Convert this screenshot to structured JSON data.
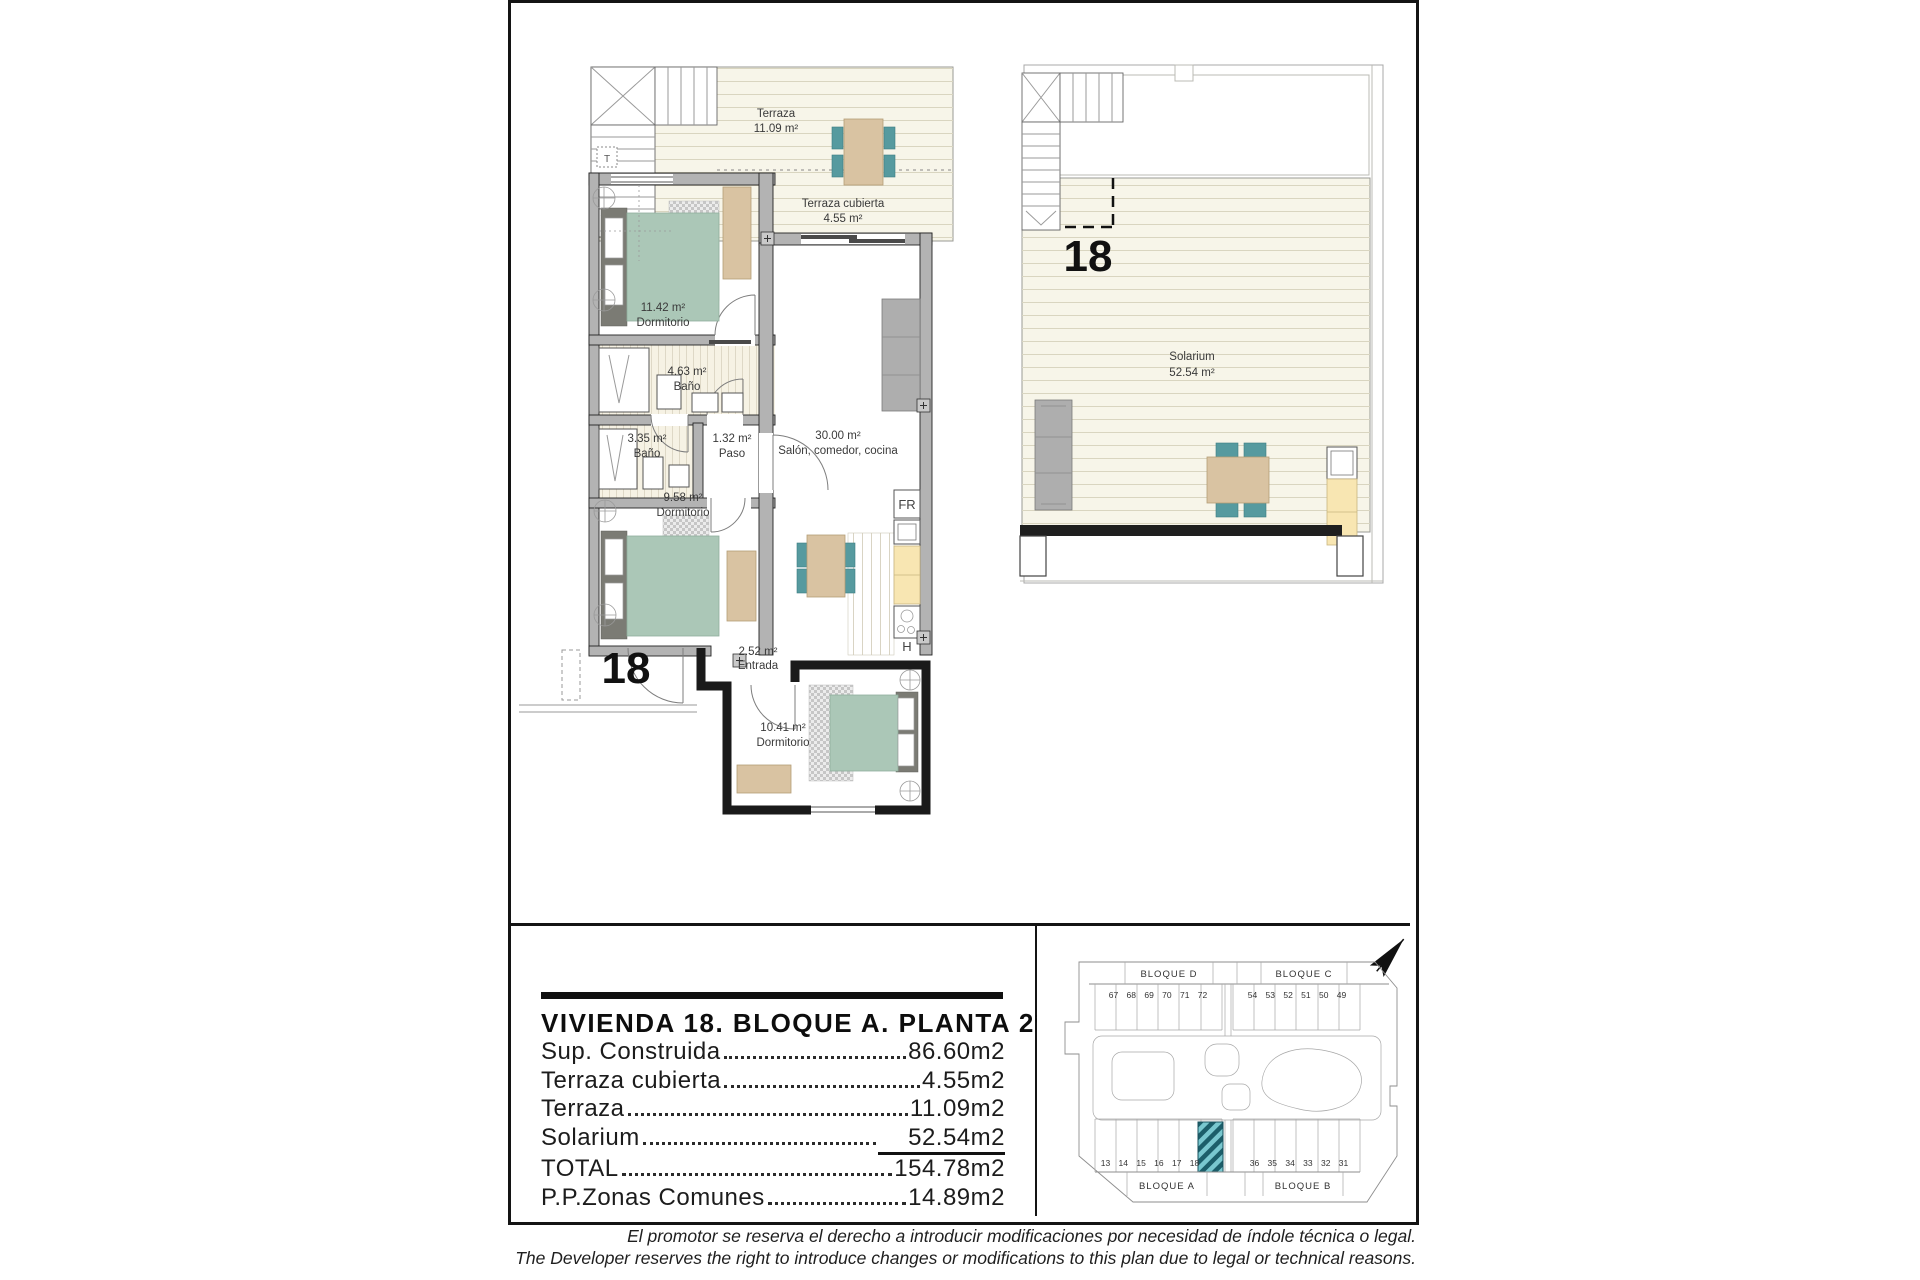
{
  "document": {
    "disclaimer_es": "El promotor se reserva el derecho a introducir modificaciones por necesidad de índole técnica o legal.",
    "disclaimer_en": "The Developer reserves the right to introduce changes or modifications to this plan due to legal or technical reasons."
  },
  "title_block": {
    "title": "VIVIENDA 18. BLOQUE A. PLANTA 2ª",
    "rows": {
      "r1": {
        "label": "Sup. Construida",
        "value": "86.60m2"
      },
      "r2": {
        "label": "Terraza cubierta",
        "value": "4.55m2"
      },
      "r3": {
        "label": "Terraza",
        "value": "11.09m2"
      },
      "r4": {
        "label": "Solarium",
        "value": "52.54m2"
      },
      "r5": {
        "label": "TOTAL",
        "value": "154.78m2"
      },
      "r6": {
        "label": "P.P.Zonas Comunes",
        "value": "14.89m2"
      }
    }
  },
  "floor_plan": {
    "unit_number": "18",
    "rooms": {
      "terraza": {
        "name": "Terraza",
        "area": "11.09 m²"
      },
      "terraza_cubierta": {
        "name": "Terraza cubierta",
        "area": "4.55 m²"
      },
      "dormitorio1": {
        "area": "11.42 m²",
        "name": "Dormitorio"
      },
      "bano1": {
        "area": "4.63 m²",
        "name": "Baño"
      },
      "bano2": {
        "area": "3.35 m²",
        "name": "Baño"
      },
      "paso": {
        "area": "1.32 m²",
        "name": "Paso"
      },
      "salon": {
        "area": "30.00 m²",
        "name": "Salón, comedor, cocina"
      },
      "dormitorio2": {
        "area": "9.58 m²",
        "name": "Dormitorio"
      },
      "entrada": {
        "area": "2.52 m²",
        "name": "Entrada"
      },
      "dormitorio3": {
        "area": "10.41 m²",
        "name": "Dormitorio"
      }
    },
    "labels": {
      "fridge": "FR",
      "hob": "H",
      "stair_t": "T"
    }
  },
  "solarium_plan": {
    "unit_number": "18",
    "room": {
      "name": "Solarium",
      "area": "52.54 m²"
    }
  },
  "site_plan": {
    "blocks": {
      "d": {
        "name": "BLOQUE D",
        "units": "67 68 69 70 71 72"
      },
      "c": {
        "name": "BLOQUE C",
        "units": "54 53 52 51 50 49"
      },
      "a": {
        "name": "BLOQUE A",
        "units": "13 14 15 16 17 18"
      },
      "b": {
        "name": "BLOQUE B",
        "units": "36 35 34 33 32 31"
      }
    },
    "highlighted_unit": "18"
  },
  "colors": {
    "accent_teal": "#569a9f",
    "highlight_hatch_dark": "#1c5e6a",
    "highlight_hatch_light": "#79c7cf",
    "furniture_tan": "#d9c3a2",
    "bed_sage": "#abc7b7",
    "counter_yellow": "#f8e6b2",
    "wall_gray": "#b3b3b3"
  }
}
